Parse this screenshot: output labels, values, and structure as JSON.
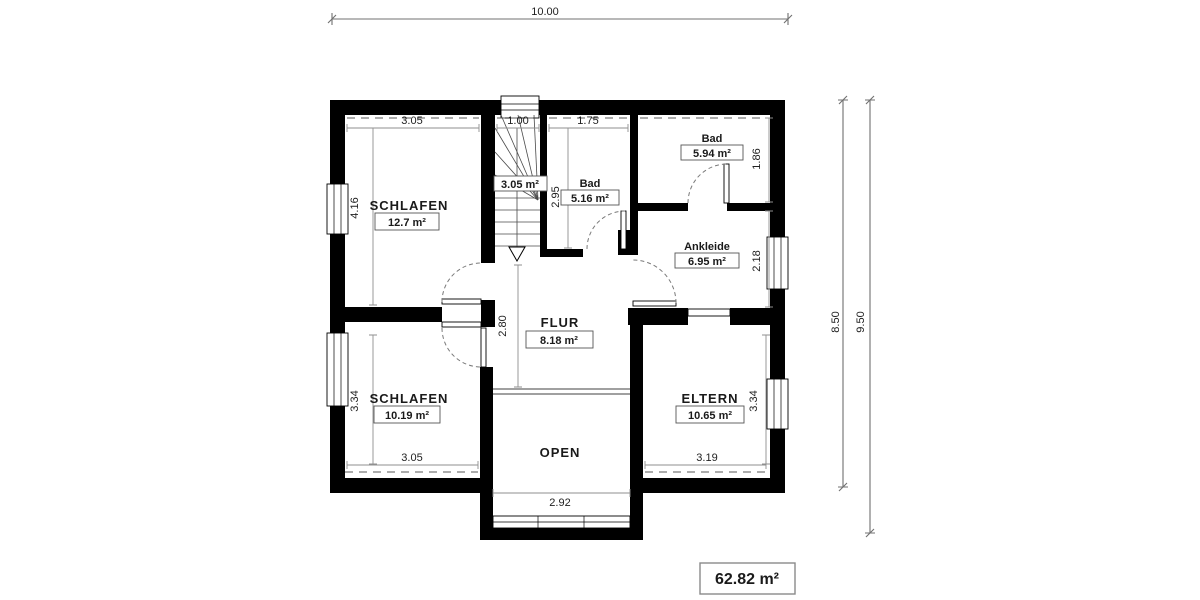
{
  "dimensions": {
    "overall_width": "10.00",
    "main_depth": "8.50",
    "total_depth": "9.50"
  },
  "rooms": {
    "schlafen_top": {
      "name": "SCHLAFEN",
      "area": "12.7 m²",
      "width": "3.05",
      "height": "4.16"
    },
    "stairs": {
      "area": "3.05 m²",
      "width": "1.00"
    },
    "bad_klein": {
      "name": "Bad",
      "area": "5.16 m²",
      "width": "1.75",
      "height": "2.95"
    },
    "bad_gross": {
      "name": "Bad",
      "area": "5.94 m²",
      "height": "1.86"
    },
    "ankleide": {
      "name": "Ankleide",
      "area": "6.95 m²",
      "height": "2.18"
    },
    "flur": {
      "name": "FLUR",
      "area": "8.18 m²",
      "height": "2.80"
    },
    "schlafen_bottom": {
      "name": "SCHLAFEN",
      "area": "10.19 m²",
      "width": "3.05",
      "height": "3.34"
    },
    "eltern": {
      "name": "ELTERN",
      "area": "10.65 m²",
      "width": "3.19",
      "height": "3.34"
    },
    "open": {
      "name": "OPEN",
      "width": "2.92"
    }
  },
  "total_area": "62.82 m²",
  "colors": {
    "wall": "#000000",
    "background": "#ffffff",
    "measure_line": "#8f8f8f",
    "text": "#1a1a1a"
  }
}
